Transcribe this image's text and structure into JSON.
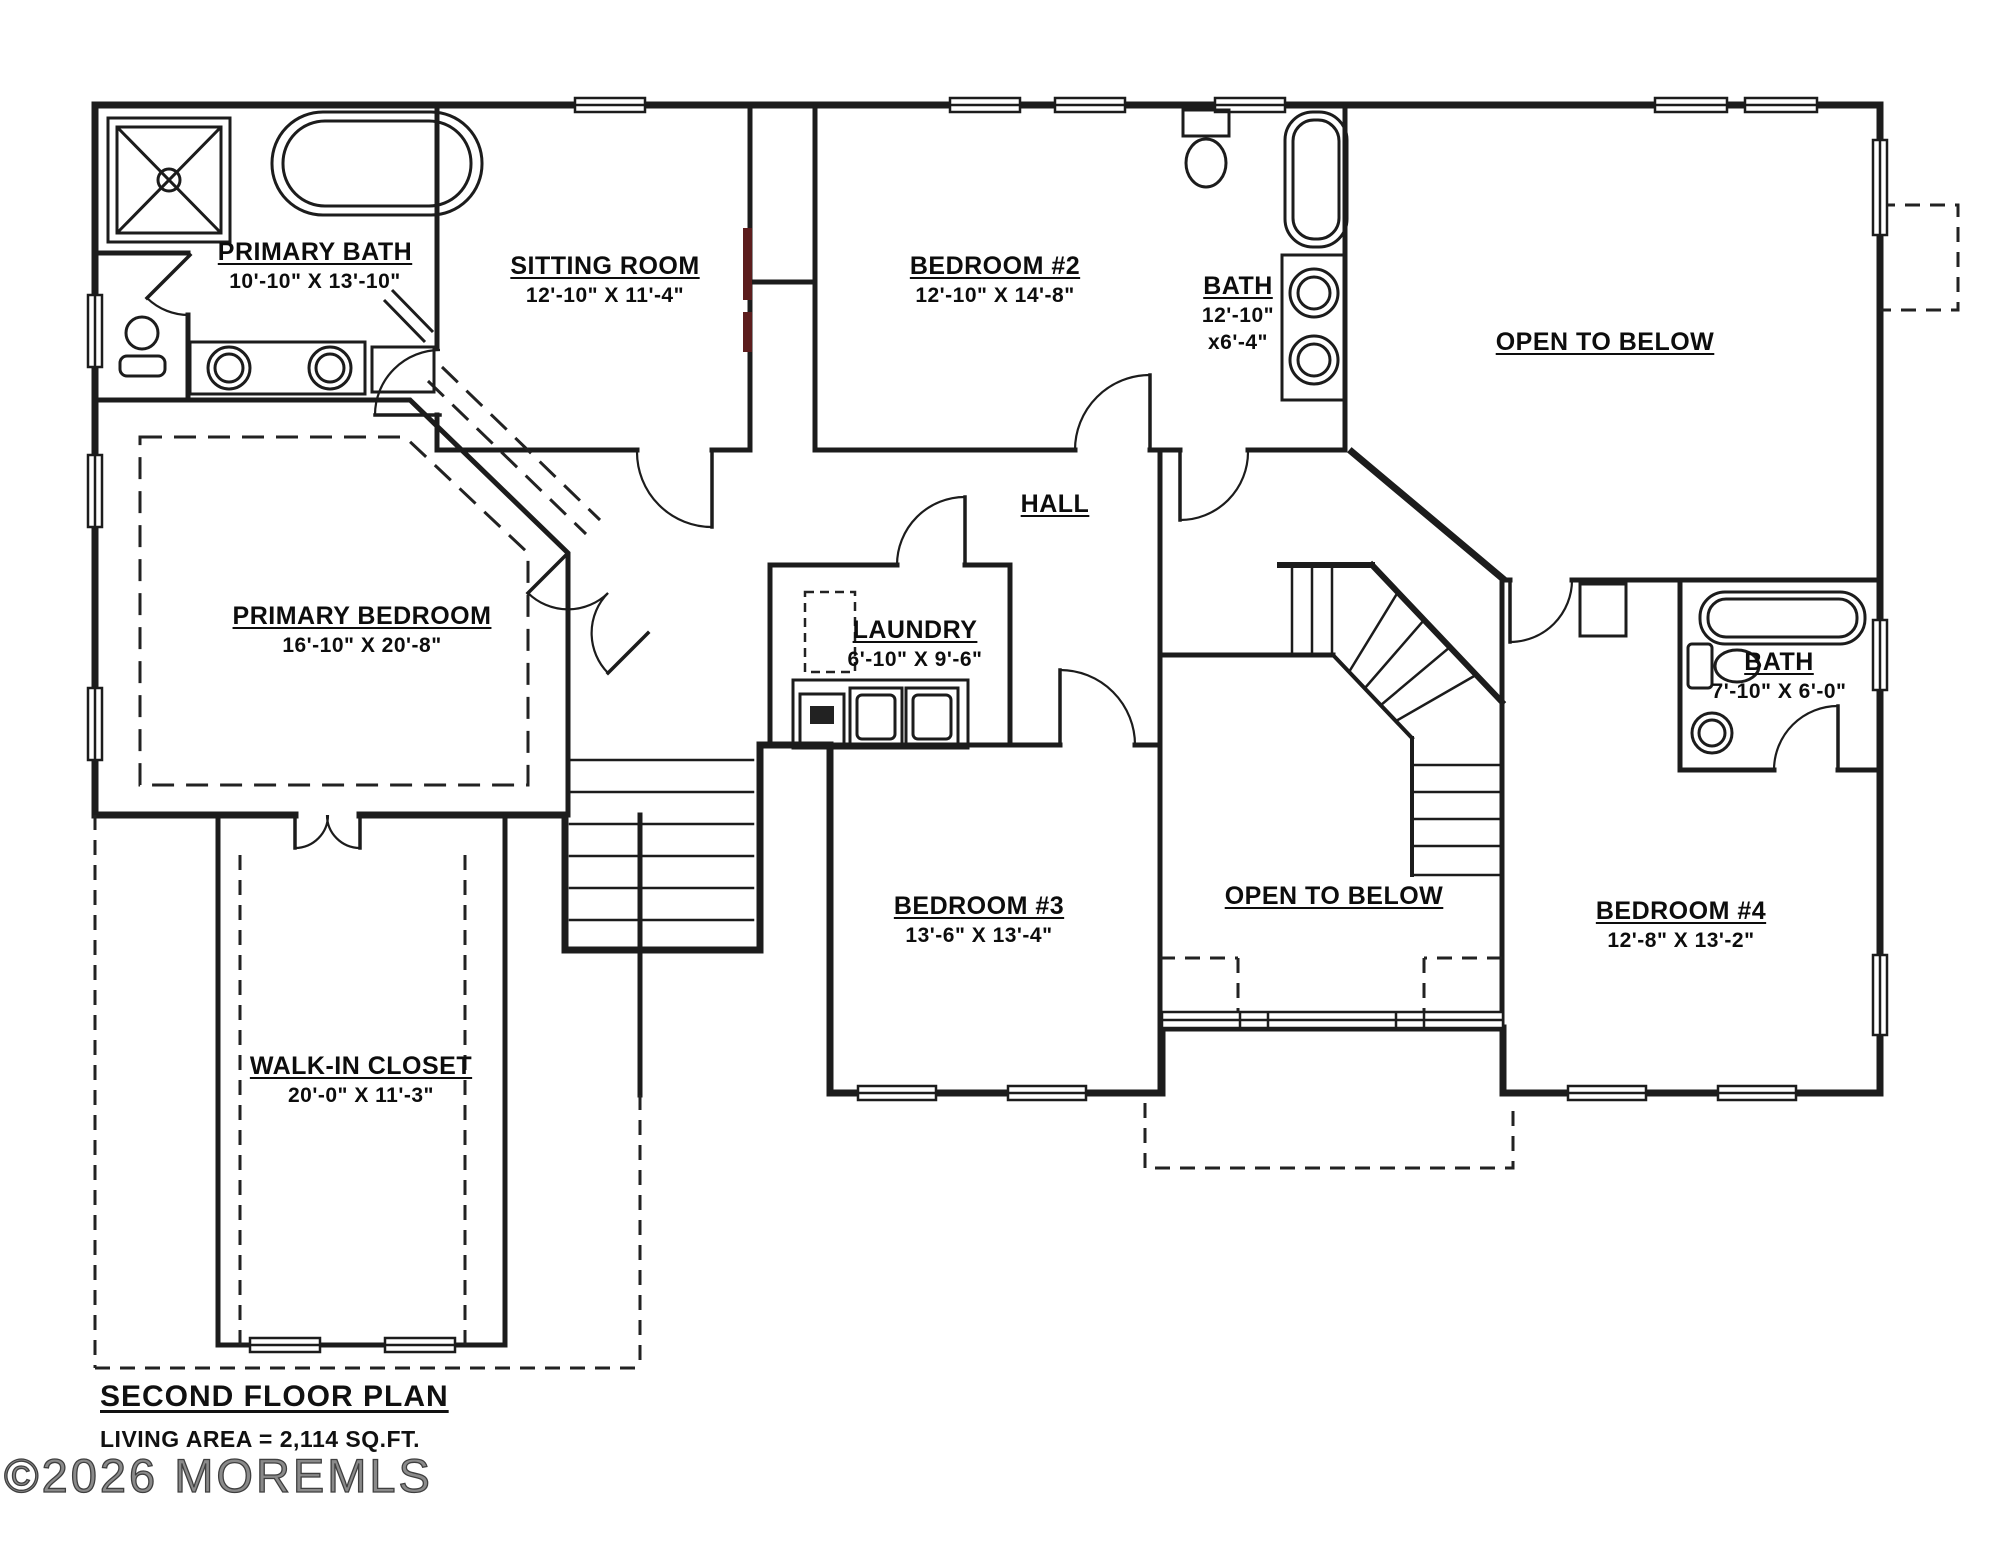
{
  "plan": {
    "title": "SECOND FLOOR PLAN",
    "living_area": "LIVING AREA = 2,114 SQ.FT.",
    "watermark": "©2026 MOREMLS"
  },
  "rooms": {
    "primary_bath": {
      "name": "PRIMARY BATH",
      "dims": "10'-10\" X 13'-10\""
    },
    "sitting_room": {
      "name": "SITTING ROOM",
      "dims": "12'-10\" X 11'-4\""
    },
    "bedroom2": {
      "name": "BEDROOM #2",
      "dims": "12'-10\" X 14'-8\""
    },
    "bath2": {
      "name": "BATH",
      "dims_line1": "12'-10\"",
      "dims_line2": "x6'-4\""
    },
    "open_to_below_upper": {
      "name": "OPEN TO BELOW"
    },
    "hall": {
      "name": "HALL"
    },
    "primary_bedroom": {
      "name": "PRIMARY BEDROOM",
      "dims": "16'-10\" X 20'-8\""
    },
    "laundry": {
      "name": "LAUNDRY",
      "dims": "6'-10\" X 9'-6\""
    },
    "bath3": {
      "name": "BATH",
      "dims": "7'-10\" X 6'-0\""
    },
    "bedroom3": {
      "name": "BEDROOM #3",
      "dims": "13'-6\" X 13'-4\""
    },
    "open_to_below_lower": {
      "name": "OPEN TO BELOW"
    },
    "bedroom4": {
      "name": "BEDROOM #4",
      "dims": "12'-8\" X 13'-2\""
    },
    "walk_in_closet": {
      "name": "WALK-IN CLOSET",
      "dims": "20'-0\" X 11'-3\""
    }
  },
  "colors": {
    "wall": "#1c1c1c",
    "dashed": "#222222",
    "closet_door_accent": "#5c1d1d",
    "background": "#ffffff"
  }
}
